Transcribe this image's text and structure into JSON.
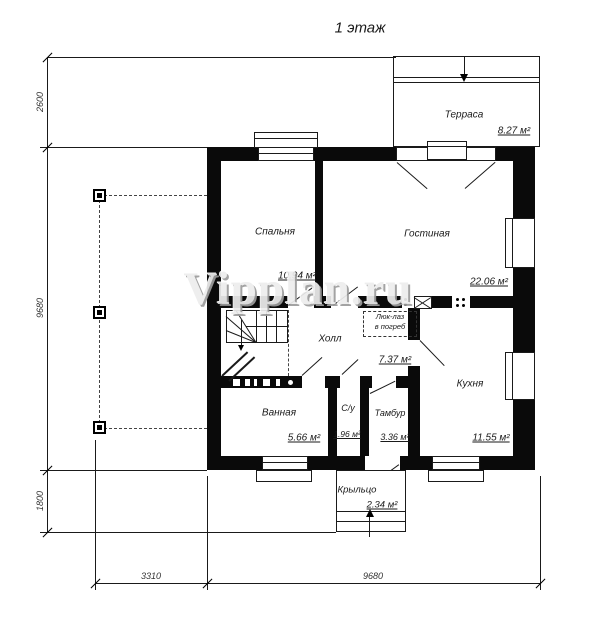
{
  "title": "1 этаж",
  "watermark": "Vipplan.ru",
  "colors": {
    "walls": "#000000",
    "background": "#ffffff",
    "watermark_gray": "#ededed"
  },
  "rooms": {
    "terrace": {
      "name": "Терраса",
      "area": "8.27 м²"
    },
    "bedroom": {
      "name": "Спальня",
      "area": "10.94 м²"
    },
    "living": {
      "name": "Гостиная",
      "area": "22.06 м²"
    },
    "hall": {
      "name": "Холл",
      "area": "7.37 м²"
    },
    "bathroom": {
      "name": "Ванная",
      "area": "5.66 м²"
    },
    "wc": {
      "name": "С/у",
      "area": "1.96 м²"
    },
    "vestibule": {
      "name": "Тамбур",
      "area": "3.36 м²"
    },
    "kitchen": {
      "name": "Кухня",
      "area": "11.55 м²"
    },
    "porch": {
      "name": "Крыльцо",
      "area": "2.34 м²"
    }
  },
  "annotations": {
    "cellar_hatch": {
      "line1": "Люк-лаз",
      "line2": "в погреб"
    }
  },
  "dimensions": {
    "left_terrace": "2600",
    "left_house": "9680",
    "left_porch": "1800",
    "bottom_carport": "3310",
    "bottom_house": "9680"
  }
}
